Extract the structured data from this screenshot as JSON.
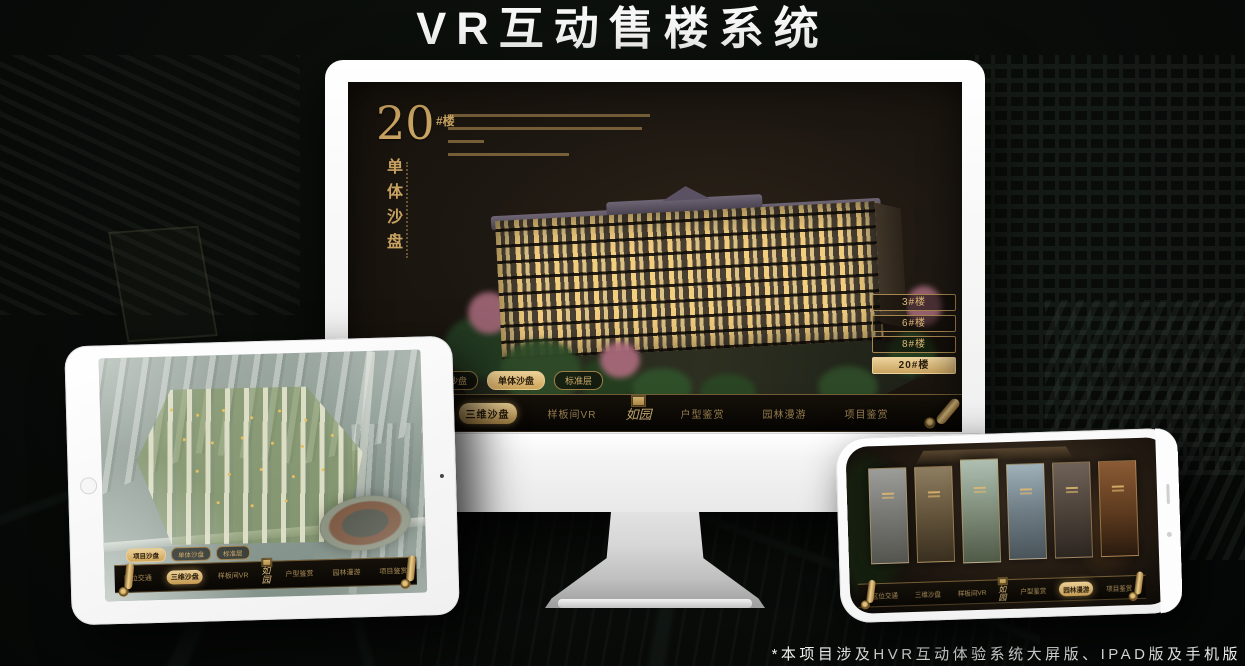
{
  "page": {
    "title": "VR互动售楼系统",
    "footnote": "*本项目涉及HVR互动体验系统大屏版、IPAD版及手机版"
  },
  "brand": {
    "logo_name": "如园",
    "accent_gold": "#c9a361",
    "highlight_gold": "#ecd097"
  },
  "desktop": {
    "hero": {
      "number": "20",
      "suffix": "#楼",
      "subtitle": "单体沙盘"
    },
    "floor_buttons": [
      {
        "label": "3#楼",
        "active": false
      },
      {
        "label": "6#楼",
        "active": false
      },
      {
        "label": "8#楼",
        "active": false
      },
      {
        "label": "20#楼",
        "active": true
      }
    ],
    "sub_tabs": [
      {
        "label": "项目沙盘",
        "active": false
      },
      {
        "label": "单体沙盘",
        "active": true
      },
      {
        "label": "标准层",
        "active": false
      }
    ],
    "nav_left": [
      {
        "label": "区位交通",
        "active": false
      },
      {
        "label": "三维沙盘",
        "active": true
      },
      {
        "label": "样板间VR",
        "active": false
      }
    ],
    "nav_right": [
      {
        "label": "户型鉴赏",
        "active": false
      },
      {
        "label": "园林漫游",
        "active": false
      },
      {
        "label": "项目鉴赏",
        "active": false
      }
    ]
  },
  "tablet": {
    "sub_tabs": [
      {
        "label": "项目沙盘",
        "active": true
      },
      {
        "label": "单体沙盘",
        "active": false
      },
      {
        "label": "标准层",
        "active": false
      }
    ],
    "nav_left": [
      {
        "label": "区位交通",
        "active": false
      },
      {
        "label": "三维沙盘",
        "active": true
      },
      {
        "label": "样板间VR",
        "active": false
      }
    ],
    "nav_right": [
      {
        "label": "户型鉴赏",
        "active": false
      },
      {
        "label": "园林漫游",
        "active": false
      },
      {
        "label": "项目鉴赏",
        "active": false
      }
    ]
  },
  "phone": {
    "nav_left": [
      {
        "label": "区位交通",
        "active": false
      },
      {
        "label": "三维沙盘",
        "active": false
      },
      {
        "label": "样板间VR",
        "active": false
      }
    ],
    "nav_right": [
      {
        "label": "户型鉴赏",
        "active": false
      },
      {
        "label": "园林漫游",
        "active": true
      },
      {
        "label": "项目鉴赏",
        "active": false
      }
    ]
  }
}
